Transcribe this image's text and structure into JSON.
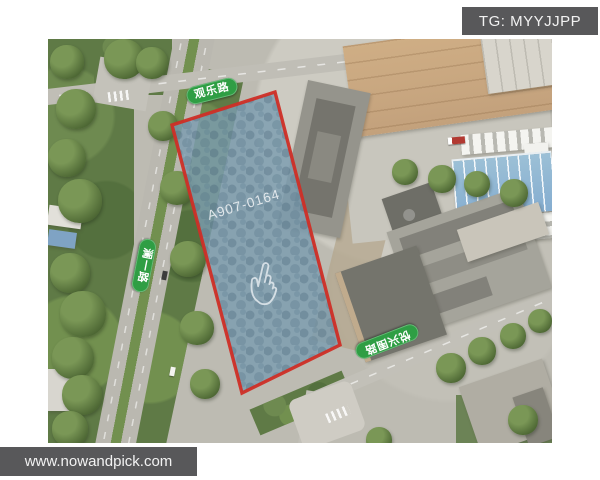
{
  "overlay": {
    "badge_text": "TG: MYYJJPP",
    "watermark_text": "www.nowandpick.com",
    "bar_color": "#58585a"
  },
  "map": {
    "type": "satellite-aerial-view",
    "parcel": {
      "code": "A907-0164",
      "fill_color": "#7b9cb0",
      "border_color": "#cf2e26",
      "cursor_icon": "pointing-hand"
    },
    "road_labels": {
      "top": "观乐路",
      "left": "澜一路",
      "bottom_right": "悦兴围路"
    },
    "label_pill_color": "#2f9e44"
  }
}
